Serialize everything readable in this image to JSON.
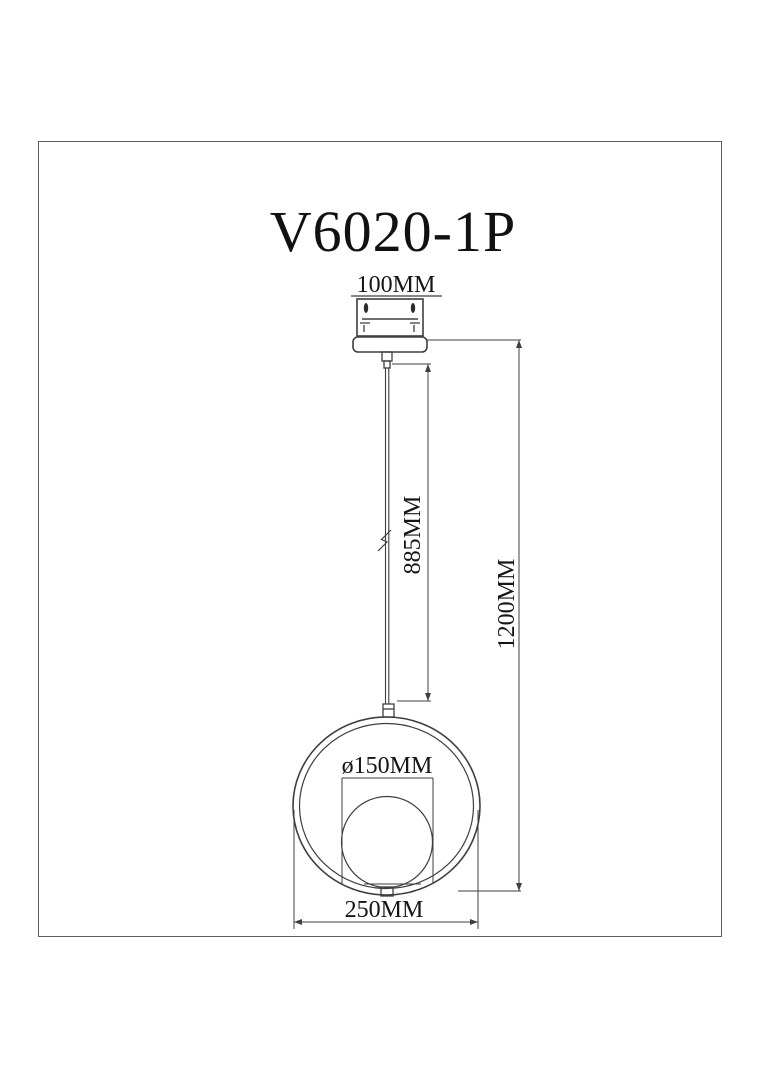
{
  "page": {
    "background": "#ffffff",
    "line_color": "#3f3f3f",
    "frame_color": "#5f5f5f"
  },
  "drawing": {
    "title": "V6020-1P"
  },
  "dimensions": {
    "canopy_width": "100MM",
    "cord_length": "885MM",
    "overall_height": "1200MM",
    "globe_diameter": "ø150MM",
    "ring_width": "250MM"
  }
}
